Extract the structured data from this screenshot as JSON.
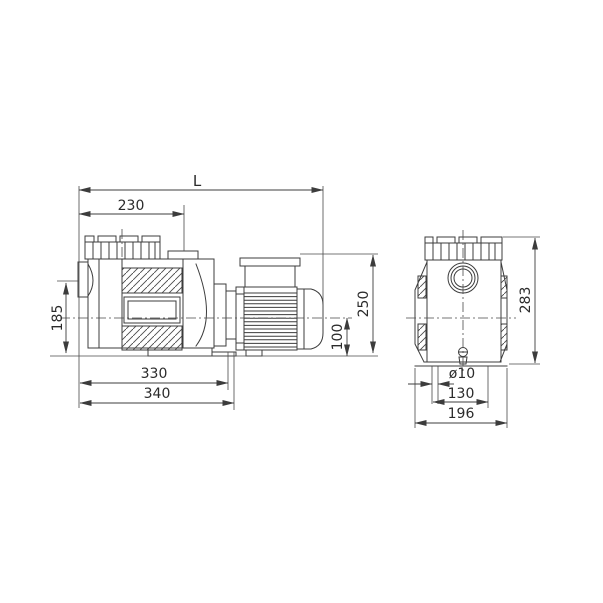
{
  "colors": {
    "line": "#3c3c3c",
    "text": "#2b2b2b",
    "background": "#ffffff"
  },
  "dimensions": {
    "side": [
      {
        "id": "overall-length",
        "label": "L",
        "orientation": "horizontal"
      },
      {
        "id": "lid-axis-to-suction-face",
        "label": "230",
        "orientation": "horizontal"
      },
      {
        "id": "suction-axis-height",
        "label": "185",
        "orientation": "vertical"
      },
      {
        "id": "base-length",
        "label": "330",
        "orientation": "horizontal"
      },
      {
        "id": "base-overall-length",
        "label": "340",
        "orientation": "horizontal"
      },
      {
        "id": "overall-height",
        "label": "250",
        "orientation": "vertical"
      },
      {
        "id": "shaft-axis-height",
        "label": "100",
        "orientation": "vertical"
      }
    ],
    "front": [
      {
        "id": "overall-height",
        "label": "283",
        "orientation": "vertical"
      },
      {
        "id": "foot-hole-diameter",
        "label": "ø10",
        "orientation": "horizontal"
      },
      {
        "id": "foot-hole-spacing",
        "label": "130",
        "orientation": "horizontal"
      },
      {
        "id": "overall-width",
        "label": "196",
        "orientation": "horizontal"
      }
    ]
  }
}
